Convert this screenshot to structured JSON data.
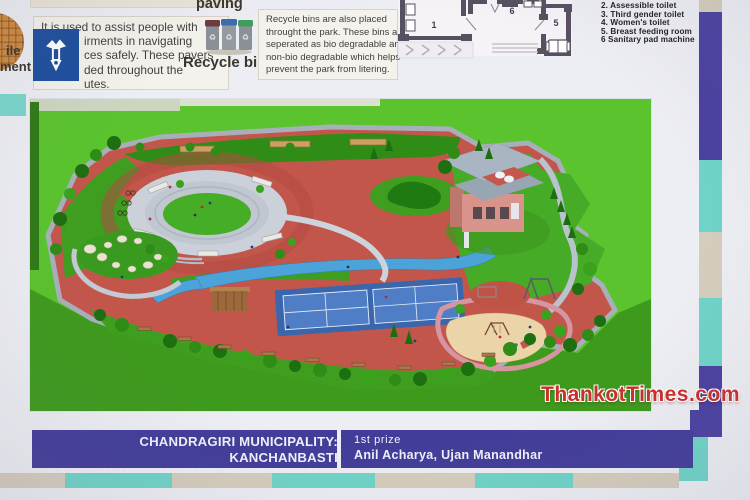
{
  "header": {
    "tactile": {
      "cut_label": {
        "line1": "ile",
        "line2": "ment"
      },
      "paving_label": "paving",
      "description_lines": [
        "It is used to assist people with",
        "irments in navigating",
        "ces safely. These pavers",
        "ded throughout the",
        "utes."
      ]
    },
    "recycle": {
      "label": "Recycle bins",
      "description_lines": [
        "Recycle bins are also placed",
        "throught the park. These bins are",
        "seperated as bio degradable and",
        "non-bio degradable which helps",
        "prevent the park from litering."
      ]
    },
    "floor_plan": {
      "room_numbers": {
        "left": "1",
        "middle": "6",
        "right": "5"
      },
      "legend_items": [
        "2. Assessible toilet",
        "3. Third gender toilet",
        "4. Women's toilet",
        "5. Breast feeding room",
        "6 Sanitary pad machine"
      ]
    }
  },
  "park_board": {
    "title_line1": "CHANDRAGIRI MUNICIPALITY: KANCHANBASTI",
    "title_line2": "AAROGYA UDHYAN PARK- “PARK FOR ALL”",
    "prize_label": "1st prize",
    "prize_names": "Anil Acharya, Ujan Manandhar"
  },
  "watermark": "ThankotTimes.com",
  "colors": {
    "band_purple": "#423d99",
    "stripe_teal": "#6fd4c8",
    "stripe_beige": "#d5cdbc",
    "lawn_green": "#5ac32d",
    "path_red": "#c3564b",
    "water_blue": "#4ba3da",
    "court_blue": "#3a66ad",
    "watermark_red": "#c9302c",
    "logo_blue": "#1c4e9d"
  }
}
